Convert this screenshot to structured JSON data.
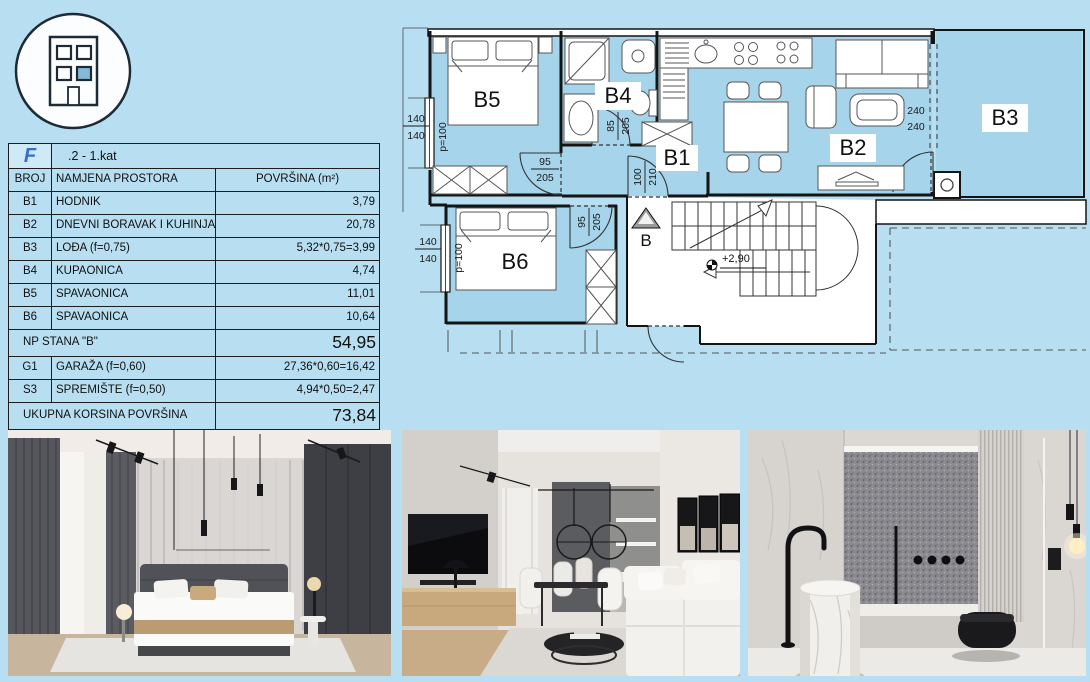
{
  "colors": {
    "page_bg": "#b7dff1",
    "room_fill": "#a6d4ea",
    "logo_blue": "#2e6fd2"
  },
  "header_icon": {
    "name": "building-icon"
  },
  "table": {
    "logo": "F",
    "title": ".2 - 1.kat",
    "columns": [
      "BROJ",
      "NAMJENA PROSTORA",
      "POVRŠINA (m²)"
    ],
    "rows": [
      {
        "id": "B1",
        "name": "HODNIK",
        "area": "3,79"
      },
      {
        "id": "B2",
        "name": "DNEVNI BORAVAK I KUHINJA",
        "area": "20,78"
      },
      {
        "id": "B3",
        "name": "LOĐA (f=0,75)",
        "area": "5,32*0,75=3,99"
      },
      {
        "id": "B4",
        "name": "KUPAONICA",
        "area": "4,74"
      },
      {
        "id": "B5",
        "name": "SPAVAONICA",
        "area": "11,01"
      },
      {
        "id": "B6",
        "name": "SPAVAONICA",
        "area": "10,64"
      }
    ],
    "subtotal": {
      "label": "NP STANA \"B\"",
      "value": "54,95"
    },
    "extra": [
      {
        "id": "G1",
        "name": "GARAŽA (f=0,60)",
        "area": "27,36*0,60=16,42"
      },
      {
        "id": "S3",
        "name": "SPREMIŠTE (f=0,50)",
        "area": "4,94*0,50=2,47"
      }
    ],
    "total": {
      "label": "UKUPNA KORSINA POVRŠINA",
      "value": "73,84"
    }
  },
  "floorplan": {
    "rooms": {
      "b1": "B1",
      "b2": "B2",
      "b3": "B3",
      "b4": "B4",
      "b5": "B5",
      "b6": "B6"
    },
    "entry": "B",
    "level": "+2,90",
    "dims": {
      "b5_win_a": "140",
      "b5_win_b": "140",
      "b5_parapet": "p=100",
      "b6_win_a": "140",
      "b6_win_b": "140",
      "b6_parapet": "p=100",
      "b5_door_a": "95",
      "b5_door_b": "205",
      "b6_door_a": "95",
      "b6_door_b": "205",
      "b4_door_a": "85",
      "b4_door_b": "205",
      "entry_a": "100",
      "entry_b": "210",
      "b3_win_a": "240",
      "b3_win_b": "240"
    }
  },
  "photos": [
    {
      "name": "bedroom-render"
    },
    {
      "name": "living-room-render"
    },
    {
      "name": "bathroom-render"
    }
  ]
}
